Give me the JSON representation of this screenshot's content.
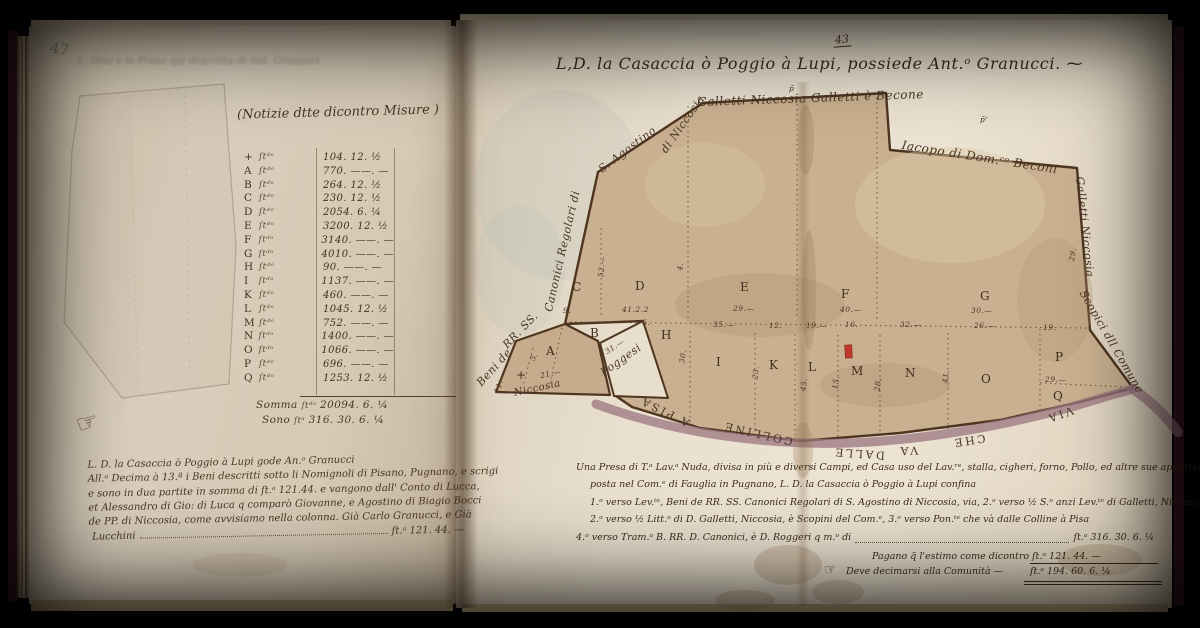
{
  "page": {
    "left_folio": "47",
    "right_folio": "43"
  },
  "colors": {
    "paper_left": "#d8cdbb",
    "paper_right": "#e9e0cf",
    "map_wash": "#c9b090",
    "road": "#9b7580",
    "ink": "#4a3524",
    "building_red": "#c03a2b",
    "pencil": "#8b8474",
    "cover": "#421a27"
  },
  "left_page": {
    "header": "(Notizie dtte dicontro Misure )",
    "ghost_text": "L. Dtta e la Presa qui descritta di Ant. Granucci",
    "unit_abbrev": "ſtᵈᵒ",
    "table_rows": [
      {
        "letter": "+",
        "value": "104. 12. ½"
      },
      {
        "letter": "A",
        "value": "770. ——. —"
      },
      {
        "letter": "B",
        "value": "264. 12. ½"
      },
      {
        "letter": "C",
        "value": "230. 12. ½"
      },
      {
        "letter": "D",
        "value": "2054. 6. ¼"
      },
      {
        "letter": "E",
        "value": "3200. 12. ½"
      },
      {
        "letter": "F",
        "value": "3140. ——. —"
      },
      {
        "letter": "G",
        "value": "4010. ——. —"
      },
      {
        "letter": "H",
        "value": "90. ——. —"
      },
      {
        "letter": "I",
        "value": "1137. ——. —"
      },
      {
        "letter": "K",
        "value": "460. ——. —"
      },
      {
        "letter": "L",
        "value": "1045. 12. ½"
      },
      {
        "letter": "M",
        "value": "752. ——. —"
      },
      {
        "letter": "N",
        "value": "1400. ——. —"
      },
      {
        "letter": "O",
        "value": "1066. ——. —"
      },
      {
        "letter": "P",
        "value": "696. ——. —"
      },
      {
        "letter": "Q",
        "value": "1253. 12. ½"
      }
    ],
    "somma_label": "Somma",
    "somma_unit": "ſtᵈᵒ",
    "somma_value": "20094. 6. ¼",
    "sono_label": "Sono",
    "sono_unit": "ſtᵃ",
    "sono_value": "316. 30. 6. ¼",
    "manicule": "☞",
    "note_lines": [
      "L. D. la Casaccia ò Poggio à Lupi gode An.ᵒ Granucci",
      "All.ᵃ Decima à 13.ª i Beni descritti sotto li Nomignoli di Pisano, Pugnano, e scrigi",
      "e sono in dua partite in somma di ſt.ᵃ 121.44. e vangono dall' Conto di Lucca,",
      "et Alessandro di Gio: di Luca q comparò Giovanne, e Agostino di Biagio Bocci",
      "de PP. di Niccosia, come avvisiamo nella colonna. Già Carlo Granucci, e Già"
    ],
    "note_last_word": "Lucchini",
    "note_total": "ſt.ᵃ 121. 44. —"
  },
  "right_page": {
    "title": "L,D. la Casaccia ò Poggio à Lupi, possiede Ant.ᵒ Granucci. ⁓",
    "map_labels": [
      {
        "t": "Galletti Niccosia Galletti è Becone",
        "x": 697,
        "y": 95,
        "r": -2,
        "s": 12
      },
      {
        "t": "Iacopo di Dom.ᶜᵒ Beconi",
        "x": 903,
        "y": 138,
        "r": 9,
        "s": 12
      },
      {
        "t": "Beni de",
        "x": 474,
        "y": 380,
        "r": -48
      },
      {
        "t": "RR. SS.",
        "x": 500,
        "y": 342,
        "r": -46
      },
      {
        "t": "Canonici Regolari di",
        "x": 542,
        "y": 310,
        "r": -77
      },
      {
        "t": "S. Agostino",
        "x": 596,
        "y": 165,
        "r": -37
      },
      {
        "t": "di Niccosia",
        "x": 658,
        "y": 148,
        "r": -55
      },
      {
        "t": "Galletti Niccosia",
        "x": 1086,
        "y": 176,
        "r": 84
      },
      {
        "t": "Scopici dll Comune",
        "x": 1088,
        "y": 288,
        "r": 60
      },
      {
        "t": "Niccosia",
        "x": 513,
        "y": 388,
        "r": -12,
        "s": 10
      },
      {
        "t": "Poggesi",
        "x": 598,
        "y": 368,
        "r": -35
      }
    ],
    "parcels": [
      {
        "t": "+",
        "x": 516,
        "y": 368
      },
      {
        "t": "A",
        "x": 546,
        "y": 344
      },
      {
        "t": "B",
        "x": 590,
        "y": 326
      },
      {
        "t": "C",
        "x": 572,
        "y": 280
      },
      {
        "t": "D",
        "x": 635,
        "y": 279
      },
      {
        "t": "E",
        "x": 740,
        "y": 280
      },
      {
        "t": "F",
        "x": 841,
        "y": 287
      },
      {
        "t": "G",
        "x": 980,
        "y": 289
      },
      {
        "t": "H",
        "x": 661,
        "y": 328
      },
      {
        "t": "I",
        "x": 716,
        "y": 355
      },
      {
        "t": "K",
        "x": 769,
        "y": 358
      },
      {
        "t": "L",
        "x": 808,
        "y": 360
      },
      {
        "t": "M",
        "x": 851,
        "y": 364
      },
      {
        "t": "N",
        "x": 905,
        "y": 366
      },
      {
        "t": "O",
        "x": 981,
        "y": 372
      },
      {
        "t": "P",
        "x": 1055,
        "y": 350
      },
      {
        "t": "Q",
        "x": 1053,
        "y": 389
      }
    ],
    "measures": [
      {
        "t": "52.—",
        "x": 591,
        "y": 262,
        "r": -83
      },
      {
        "t": "4.",
        "x": 676,
        "y": 262,
        "r": -83
      },
      {
        "t": "41.2.2",
        "x": 622,
        "y": 305
      },
      {
        "t": "29.—",
        "x": 733,
        "y": 304
      },
      {
        "t": "40.—",
        "x": 840,
        "y": 305
      },
      {
        "t": "30.—",
        "x": 971,
        "y": 306
      },
      {
        "t": "9.",
        "x": 563,
        "y": 306
      },
      {
        "t": "6.",
        "x": 642,
        "y": 318
      },
      {
        "t": "35.—",
        "x": 713,
        "y": 320
      },
      {
        "t": "12.",
        "x": 769,
        "y": 321
      },
      {
        "t": "19.—",
        "x": 806,
        "y": 321
      },
      {
        "t": "16.",
        "x": 845,
        "y": 320
      },
      {
        "t": "32.—",
        "x": 900,
        "y": 320
      },
      {
        "t": "26.—",
        "x": 974,
        "y": 321
      },
      {
        "t": "30.",
        "x": 676,
        "y": 352,
        "r": -83
      },
      {
        "t": "23.",
        "x": 749,
        "y": 368,
        "r": -83
      },
      {
        "t": "45.",
        "x": 797,
        "y": 380,
        "r": -83
      },
      {
        "t": "15.",
        "x": 829,
        "y": 378,
        "r": -83
      },
      {
        "t": "28.",
        "x": 871,
        "y": 380,
        "r": -83
      },
      {
        "t": "41.",
        "x": 939,
        "y": 372,
        "r": -83
      },
      {
        "t": "29.",
        "x": 1066,
        "y": 250,
        "r": -80
      },
      {
        "t": "19.",
        "x": 1043,
        "y": 323
      },
      {
        "t": "29.—",
        "x": 1045,
        "y": 375
      },
      {
        "t": "31.—",
        "x": 604,
        "y": 342,
        "r": -33
      },
      {
        "t": "21.—",
        "x": 540,
        "y": 369,
        "r": -12
      },
      {
        "t": "5.",
        "x": 530,
        "y": 352,
        "r": -60
      },
      {
        "t": "11.",
        "x": 492,
        "y": 382,
        "r": -70
      },
      {
        "t": "p̃",
        "x": 789,
        "y": 84
      },
      {
        "t": "p̃ʳ",
        "x": 980,
        "y": 115
      }
    ],
    "road_words": [
      {
        "t": "VIA",
        "x": 1046,
        "y": 408,
        "r": 160
      },
      {
        "t": "CHE",
        "x": 952,
        "y": 434,
        "r": 171
      },
      {
        "t": "VA",
        "x": 898,
        "y": 444,
        "r": 178
      },
      {
        "t": "DALLE",
        "x": 833,
        "y": 447,
        "r": 184
      },
      {
        "t": "COLLINE",
        "x": 722,
        "y": 427,
        "r": 193
      },
      {
        "t": "A PISA",
        "x": 638,
        "y": 405,
        "r": 206
      }
    ],
    "desc_lines": [
      "Una Presa di T.ᵃ Lav.ᵃ Nuda, divisa in più e diversi Campi, ed Casa uso del Lav.ʳᵉ, stalla, cigheri, forno, Pollo, ed altre sue appartenenze,",
      "posta nel Com.ᵉ di Fauglia in Pugnano, L. D. la Casaccia ò Poggio à Lupi confina",
      "1.ᵒ verso Lev.ᵗᵉ, Beni de RR. SS. Canonici Regolari di S. Agostino di Niccosia, via, 2.ᵒ verso ½ S.ᵒ anzi Lev.ᵗᵉ di Galletti, Niccosia, Galletti, è Becone",
      "2.ᵒ verso ½ Litt.ᵒ di D. Galletti, Niccosia, è Scopini del Com.ᵉ, 3.ᵒ verso Pon.ᵗᵉ che và dalle Colline à Pisa"
    ],
    "desc5_text": "4.ᵒ verso Tram.ᵃ B. RR. D. Canonici, è D. Roggeri q m.ᵒ di",
    "totals": {
      "row1_value": "ſt.ᵃ 316. 30. 6. ¼",
      "row2_text": "Pagano q̃ l'estimo come dicontro",
      "row2_value": "ſt.ᵒ 121. 44. —",
      "row3_text": "Deve decimarsi alla Comunità —",
      "row3_value": "ſt.ᵃ 194. 60. 6. ¼",
      "manicule": "☞"
    }
  }
}
